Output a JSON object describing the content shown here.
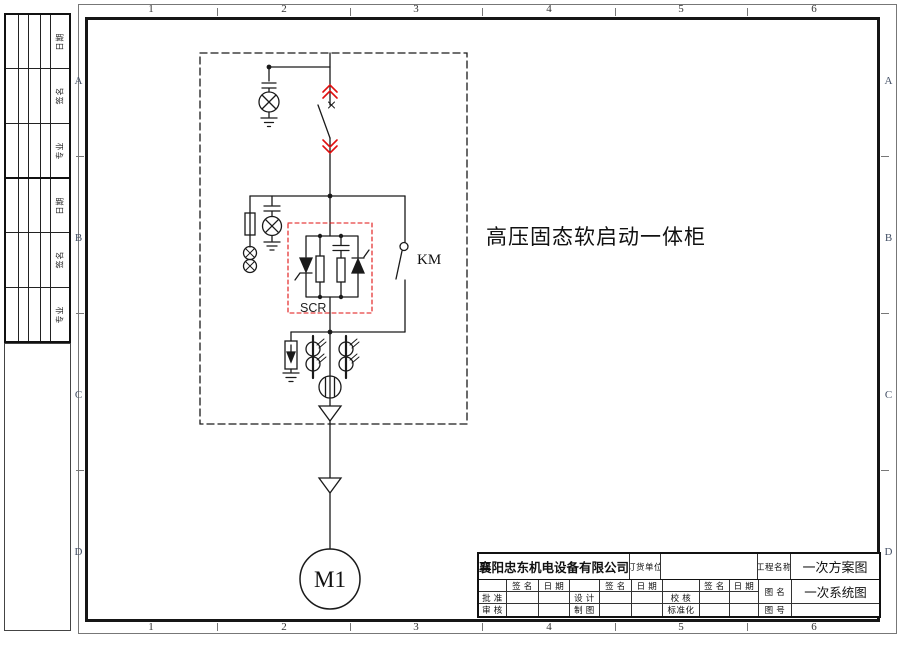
{
  "frame": {
    "columns": [
      "1",
      "2",
      "3",
      "4",
      "5",
      "6"
    ],
    "rows": [
      "A",
      "B",
      "C",
      "D"
    ]
  },
  "signature_strip": {
    "labels": [
      "日期",
      "签名",
      "专业",
      "日期",
      "签名",
      "专业"
    ]
  },
  "schematic": {
    "cabinet_label": "高压固态软启动一体柜",
    "contactor_label": "KM",
    "scr_label": "SCR",
    "motor_label": "M1"
  },
  "title_block": {
    "company": "襄阳忠东机电设备有限公司",
    "order_unit_label": "订货单位",
    "order_unit_value": "",
    "project_label": "工程名称",
    "project_value": "一次方案图",
    "drawing_name_label": "图 名",
    "drawing_name_value": "一次系统图",
    "drawing_no_label": "图 号",
    "drawing_no_value": "",
    "sign_header": "签 名",
    "date_header": "日 期",
    "roles": {
      "approve": "批 准",
      "review": "审 核",
      "design": "设 计",
      "draft": "制 图",
      "check": "校 核",
      "standard": "标准化"
    }
  },
  "colors": {
    "line": "#1a1a1a",
    "accent_red": "#e01010",
    "row_letter": "#445066"
  }
}
